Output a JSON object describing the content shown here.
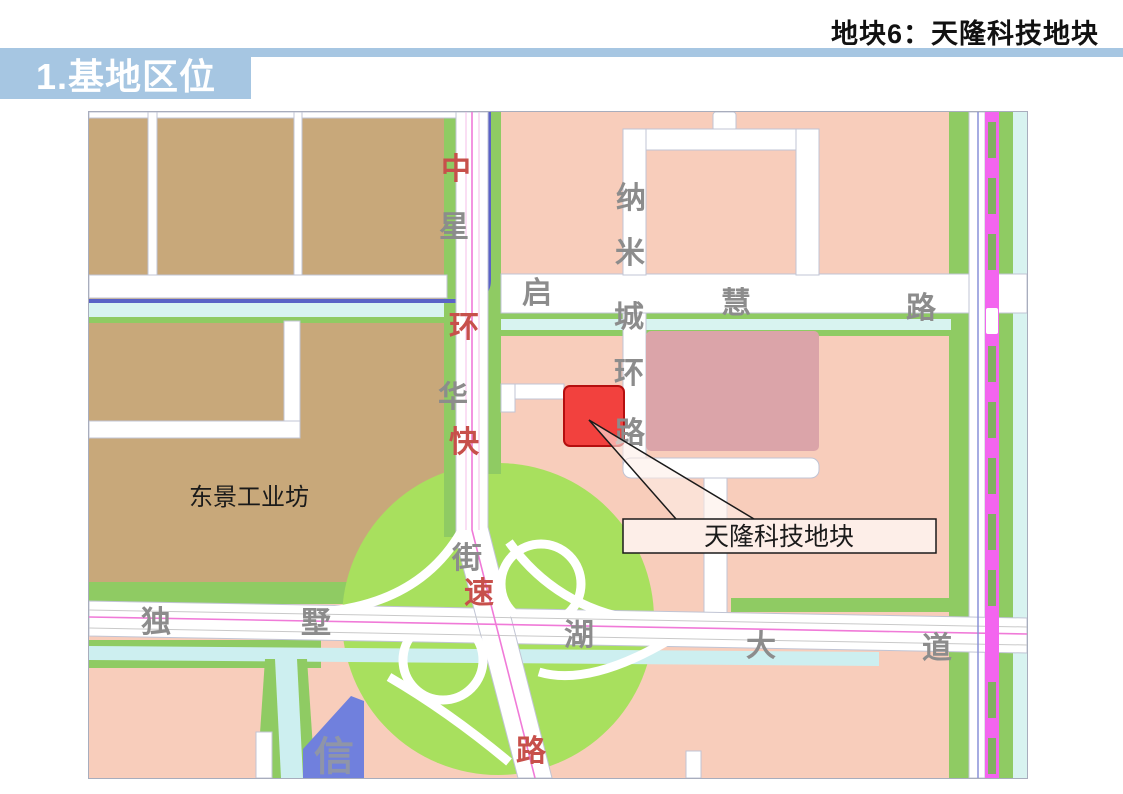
{
  "header": {
    "slide_title": "地块6：天隆科技地块",
    "section_title": "1.基地区位"
  },
  "map": {
    "area_labels": {
      "industrial_park": "东景工业坊",
      "building_xin": "信"
    },
    "roads": {
      "expressway": "中环快速路",
      "street": "星华街",
      "ring_road": "纳米城环路",
      "qihui_road": "启慧路",
      "avenue": "独墅湖大道"
    },
    "road_chars": [
      {
        "ch": "中",
        "road": "中环快速路"
      },
      {
        "ch": "星",
        "road": "星华街"
      },
      {
        "ch": "环",
        "road": "中环快速路"
      },
      {
        "ch": "华",
        "road": "星华街"
      },
      {
        "ch": "快",
        "road": "中环快速路"
      },
      {
        "ch": "街",
        "road": "星华街"
      },
      {
        "ch": "速",
        "road": "中环快速路"
      },
      {
        "ch": "路",
        "road": "中环快速路"
      },
      {
        "ch": "纳",
        "road": "纳米城环路"
      },
      {
        "ch": "米",
        "road": "纳米城环路"
      },
      {
        "ch": "城",
        "road": "纳米城环路"
      },
      {
        "ch": "环",
        "road": "纳米城环路"
      },
      {
        "ch": "路",
        "road": "纳米城环路"
      },
      {
        "ch": "启",
        "road": "启慧路"
      },
      {
        "ch": "慧",
        "road": "启慧路"
      },
      {
        "ch": "路",
        "road": "启慧路"
      },
      {
        "ch": "独",
        "road": "独墅湖大道"
      },
      {
        "ch": "墅",
        "road": "独墅湖大道"
      },
      {
        "ch": "湖",
        "road": "独墅湖大道"
      },
      {
        "ch": "大",
        "road": "独墅湖大道"
      },
      {
        "ch": "道",
        "road": "独墅湖大道"
      }
    ],
    "callout": {
      "label": "天隆科技地块"
    },
    "colors": {
      "banner_blue": "#a6c6e2",
      "block_salmon": "#f8cdbb",
      "block_brown": "#c8a87a",
      "block_rose": "#dba4a9",
      "plot_red": "#f2413e",
      "plot_border_red": "#b50f0f",
      "roadside_green": "#8fcb63",
      "interchange_green": "#a8e05e",
      "water_cyan": "#d8f3f0",
      "river_blue": "#5a62c6",
      "rail_magenta": "#f365ef",
      "centerline_magenta": "#f07ad8",
      "building_blue": "#7080dd",
      "road_label_gray": "#8c8c8c",
      "road_label_red": "#c7504b",
      "callout_fill": "#fdeee8"
    }
  }
}
